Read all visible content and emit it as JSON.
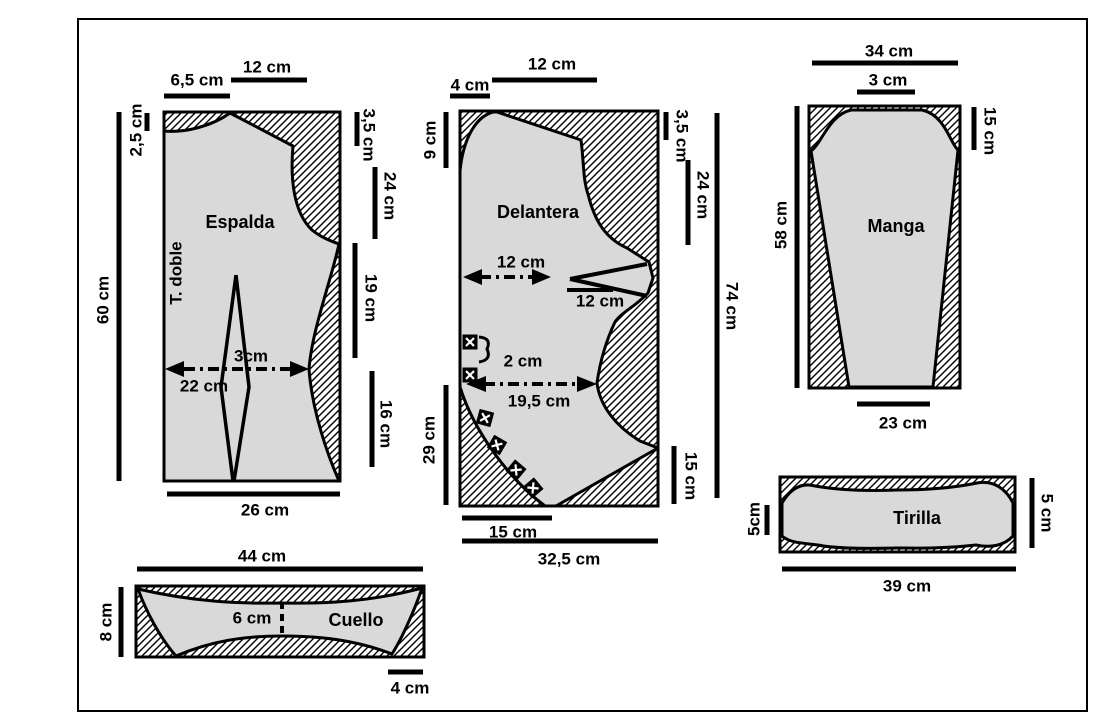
{
  "figure": {
    "type": "sewing-pattern-cutting-diagram"
  },
  "colors": {
    "piece_fill": "#d9d9d9",
    "line": "#000000",
    "background": "#ffffff"
  },
  "pieces": {
    "espalda": {
      "name": "Espalda",
      "fold_label": "T. doble",
      "dims": {
        "shoulder_top": "6,5 cm",
        "top_width": "12 cm",
        "neck_drop": "2,5 cm",
        "side_height": "60 cm",
        "armhole_top": "3,5 cm",
        "armhole_depth": "24 cm",
        "waist_side": "19 cm",
        "hip_side": "16 cm",
        "dart_width": "3cm",
        "waist_width": "22 cm",
        "bottom_width": "26 cm"
      }
    },
    "delantera": {
      "name": "Delantera",
      "dims": {
        "front_edge": "4 cm",
        "top_width": "12 cm",
        "neck_depth": "9 cm",
        "armhole_top": "3,5 cm",
        "armhole_depth": "24 cm",
        "full_height": "74 cm",
        "chest_width": "12 cm",
        "dart_length": "12 cm",
        "button_spacing": "2 cm",
        "waist_width": "19,5 cm",
        "curve_height": "29 cm",
        "side_bottom": "15 cm",
        "bottom_short": "15 cm",
        "bottom_width": "32,5 cm"
      }
    },
    "manga": {
      "name": "Manga",
      "dims": {
        "top_width": "34 cm",
        "cap_flat": "3 cm",
        "cap_height": "15 cm",
        "length": "58 cm",
        "bottom_width": "23 cm"
      }
    },
    "tirilla": {
      "name": "Tirilla",
      "dims": {
        "left_height": "5cm",
        "right_height": "5 cm",
        "bottom_width": "39 cm"
      }
    },
    "cuello": {
      "name": "Cuello",
      "dims": {
        "top_width": "44 cm",
        "left_height": "8 cm",
        "center_width": "6 cm",
        "bottom_right": "4 cm"
      }
    }
  }
}
